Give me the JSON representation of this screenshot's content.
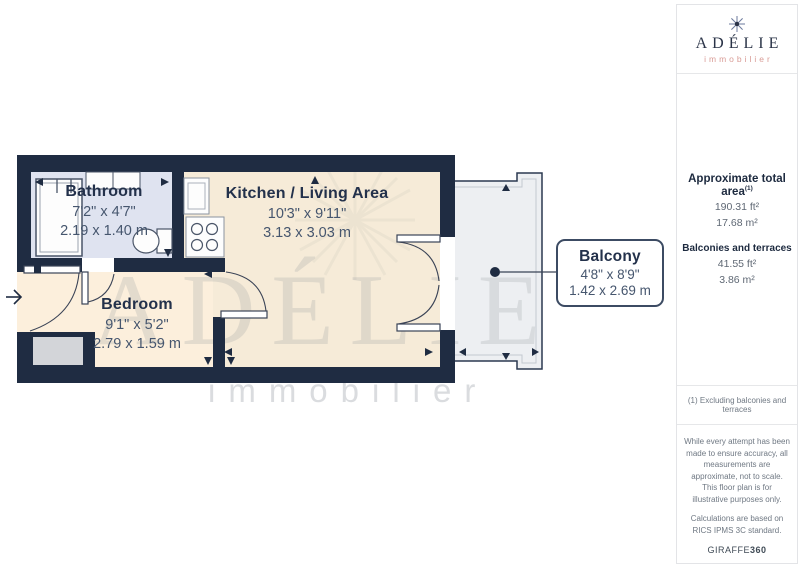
{
  "brand_logo": {
    "icon": "snowflake-icon",
    "name": "ADÉLIE",
    "subtitle": "immobilier"
  },
  "sidebar": {
    "total_area_label": "Approximate total area",
    "total_area_sup": "(1)",
    "total_area_ft": "190.31 ft²",
    "total_area_m": "17.68 m²",
    "balconies_label": "Balconies and terraces",
    "balconies_ft": "41.55 ft²",
    "balconies_m": "3.86 m²",
    "footnote": "(1) Excluding balconies and terraces",
    "disclaimer": "While every attempt has been made to ensure accuracy, all measurements are approximate, not to scale. This floor plan is for illustrative purposes only.",
    "standard_note": "Calculations are based on RICS IPMS 3C standard.",
    "provider": "GIRAFFE",
    "provider_suffix": "360"
  },
  "floorplan": {
    "rooms": [
      {
        "name": "Bathroom",
        "imperial": "7'2\" x 4'7\"",
        "metric": "2.19 x 1.40 m"
      },
      {
        "name": "Kitchen / Living Area",
        "imperial": "10'3\" x 9'11\"",
        "metric": "3.13 x 3.03 m"
      },
      {
        "name": "Bedroom",
        "imperial": "9'1\" x 5'2\"",
        "metric": "2.79 x 1.59 m"
      },
      {
        "name": "Balcony",
        "imperial": "4'8\" x 8'9\"",
        "metric": "1.42 x 2.69 m"
      }
    ],
    "watermark_title": "ADÉLIE",
    "watermark_subtitle": "immobilier",
    "colors": {
      "wall": "#1f2c42",
      "bathroom_floor": "#dfe3f0",
      "kitchen_floor": "#f6ebd8",
      "bedroom_floor": "#fcefdc",
      "balcony_floor": "#edeff2",
      "logo_subtitle": "#d99c96"
    }
  }
}
